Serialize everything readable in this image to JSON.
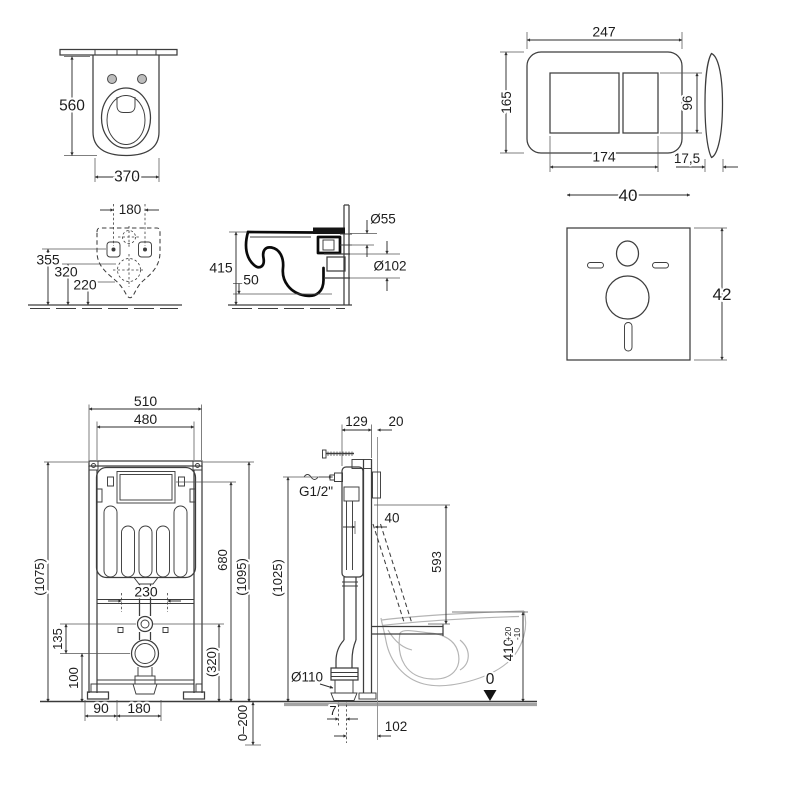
{
  "drawing": {
    "type": "sanitary installation technical drawing",
    "background_color": "#ffffff",
    "line_color": "#3d3d3d",
    "ghost_color": "#b4b4b4",
    "views": {
      "bowl_top": {
        "depth": "560",
        "width": "370"
      },
      "flush_plate": {
        "width": "247",
        "height": "165",
        "buttons_width": "174",
        "buttons_height": "96",
        "thickness": "17,5"
      },
      "bowl_rear": {
        "holes_spacing": "180",
        "holes_height": "355",
        "mid_height": "320",
        "drain_height": "220"
      },
      "bowl_side": {
        "depth": "415",
        "ledge": "50",
        "flush_pipe": "Ø55",
        "drain_pipe": "Ø102"
      },
      "sound_pad": {
        "width": "40",
        "height": "42"
      },
      "frame_front": {
        "width_outer": "510",
        "width_inner": "480",
        "height_left": "(1075)",
        "opening_height": "680",
        "height_right": "(1095)",
        "connections_spacing": "230",
        "offset_valve_drain": "135",
        "drain_height": "100",
        "offset_320": "(320)",
        "foot_offset": "90",
        "foot_spacing": "180",
        "feet_adjust_range": "0–200"
      },
      "frame_side": {
        "depth": "129",
        "front_gap": "20",
        "water_supply": "G1/2\"",
        "flush_offset": "40",
        "flush_drop": "593",
        "supply_height": "(1025)",
        "drain_diameter": "Ø110",
        "bowl_height": "410",
        "bowl_height_tol_plus": "+20",
        "bowl_height_tol_minus": "-10",
        "floor_level": "0",
        "drain_offset": "7",
        "drain_wall_distance": "102"
      }
    }
  }
}
